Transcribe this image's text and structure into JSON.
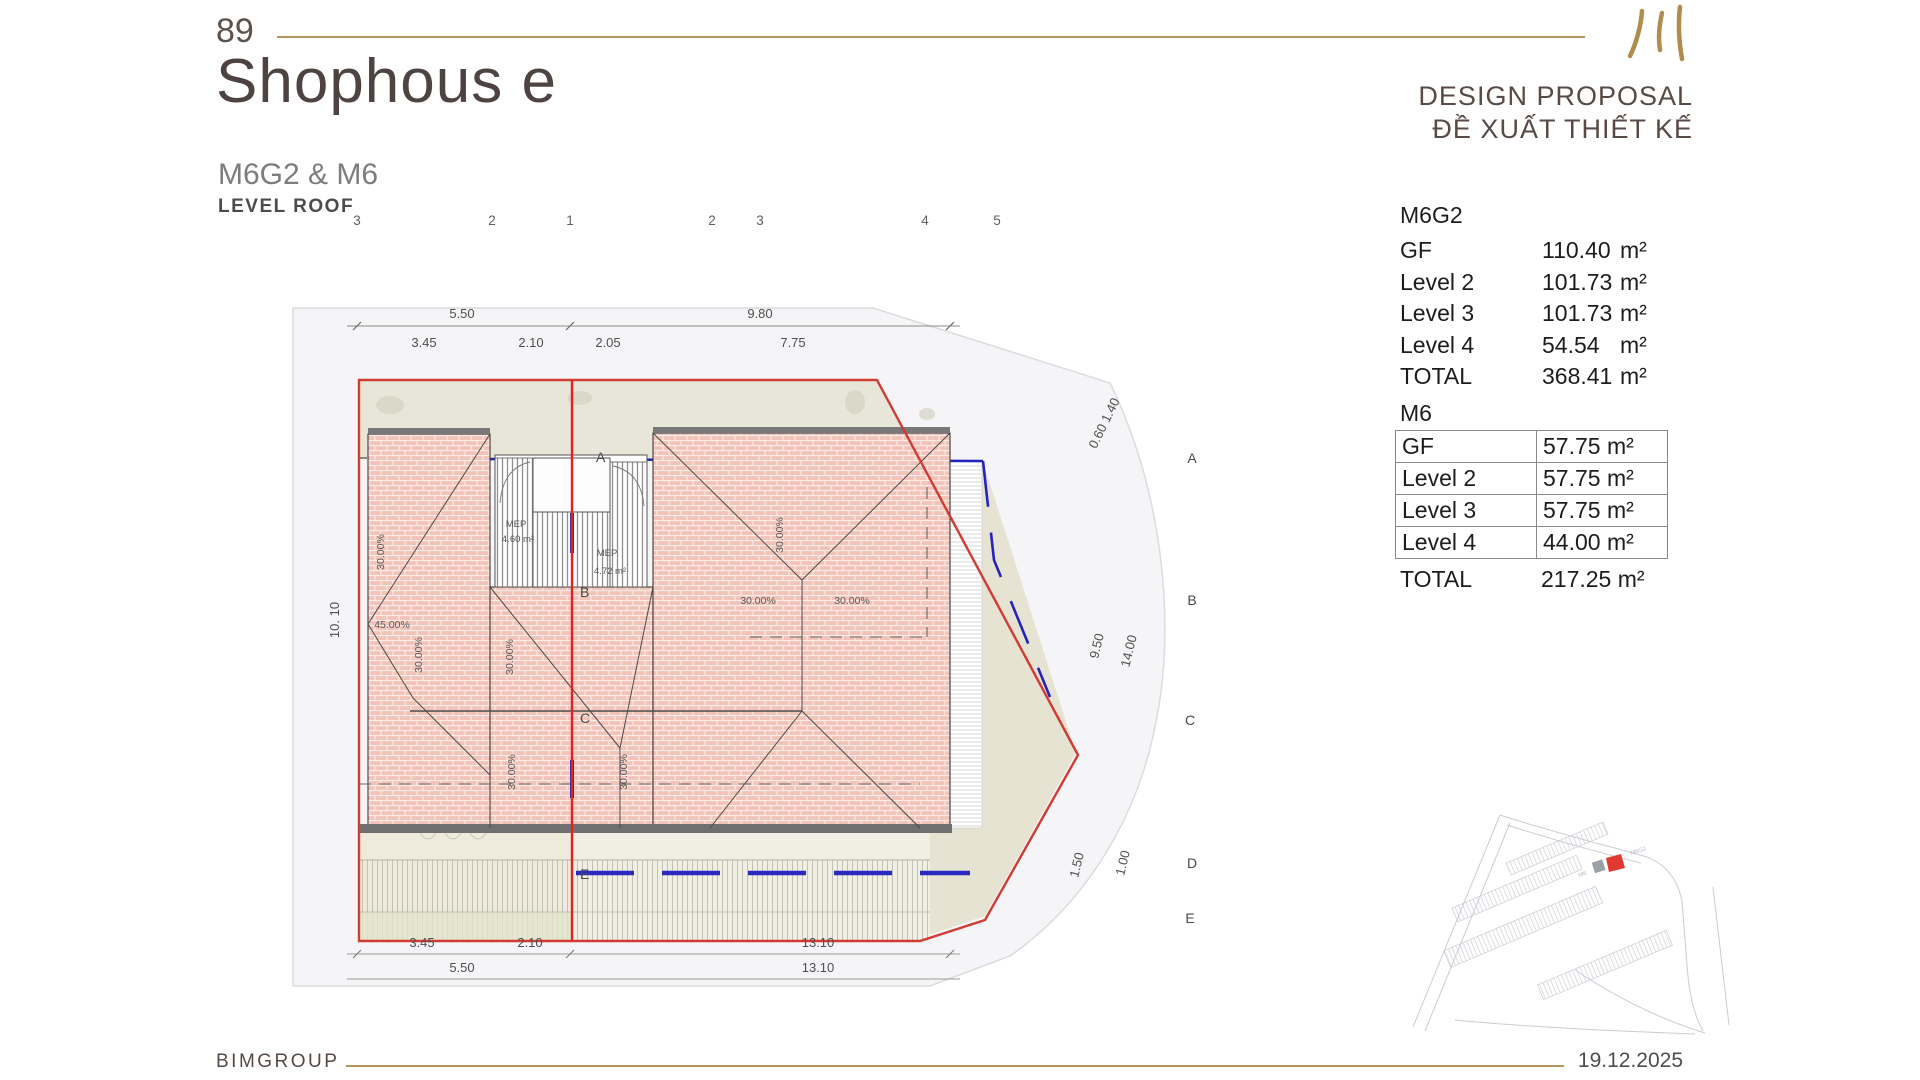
{
  "slide": {
    "page_number": "89",
    "title": "Shophous e",
    "subtitle": "M6G2 & M6",
    "level_label": "LEVEL ROOF",
    "proposal_line1": "DESIGN PROPOSAL",
    "proposal_line2": "ĐỀ XUẤT THIẾT KẾ",
    "company": "BIMGROUP",
    "date": "19.12.2025",
    "accent_gold": "#b5945e",
    "logo_icon": "three-brush-strokes"
  },
  "area_tables": {
    "m6g2": {
      "name": "M6G2",
      "rows": [
        {
          "label": "GF",
          "value": "110.40",
          "unit": "m²"
        },
        {
          "label": "Level 2",
          "value": "101.73",
          "unit": "m²"
        },
        {
          "label": "Level 3",
          "value": "101.73",
          "unit": "m²"
        },
        {
          "label": "Level 4",
          "value": "54.54",
          "unit": "m²"
        }
      ],
      "total": {
        "label": "TOTAL",
        "value": "368.41",
        "unit": "m²"
      }
    },
    "m6": {
      "name": "M6",
      "rows": [
        {
          "label": "GF",
          "value": "57.75 m²"
        },
        {
          "label": "Level 2",
          "value": "57.75 m²"
        },
        {
          "label": "Level 3",
          "value": "57.75 m²"
        },
        {
          "label": "Level 4",
          "value": "44.00 m²"
        }
      ],
      "total": {
        "label": "TOTAL",
        "value": "217.25 m²"
      }
    }
  },
  "plan": {
    "grid_numbers_top": [
      "3",
      "2",
      "1",
      "2",
      "3",
      "4",
      "5"
    ],
    "grid_letters_right": [
      "A",
      "B",
      "C",
      "D",
      "E"
    ],
    "grid_letters_inner": [
      "A",
      "B",
      "C",
      "E"
    ],
    "dims_top_row1": [
      "5.50",
      "9.80"
    ],
    "dims_top_row2": [
      "3.45",
      "2.10",
      "2.05",
      "7.75"
    ],
    "dims_bottom_row1": [
      "3.45",
      "2.10",
      "13.10"
    ],
    "dims_bottom_row2": [
      "5.50",
      "13.10"
    ],
    "dim_left": "10. 10",
    "dims_right": [
      "0.60 1.40",
      "9.50",
      "14.00",
      "1.50",
      "1.00"
    ],
    "slope30": "30.00%",
    "slope45": "45.00%",
    "mep1": {
      "name": "MEP",
      "area": "4.60 m²"
    },
    "mep2": {
      "name": "MEP",
      "area": "4.72 m²"
    },
    "colors": {
      "boundary_red": "#d23b34",
      "divider_red": "#e0241c",
      "setback_blue": "#2a2ac0",
      "roof_pink": "#f1c3b9",
      "terrace_beige": "#eeebdc",
      "site_gray": "#f5f5f7"
    }
  },
  "minimap": {
    "labels": [
      "M6G2",
      "M6"
    ],
    "marker_color": "#e03a30"
  }
}
